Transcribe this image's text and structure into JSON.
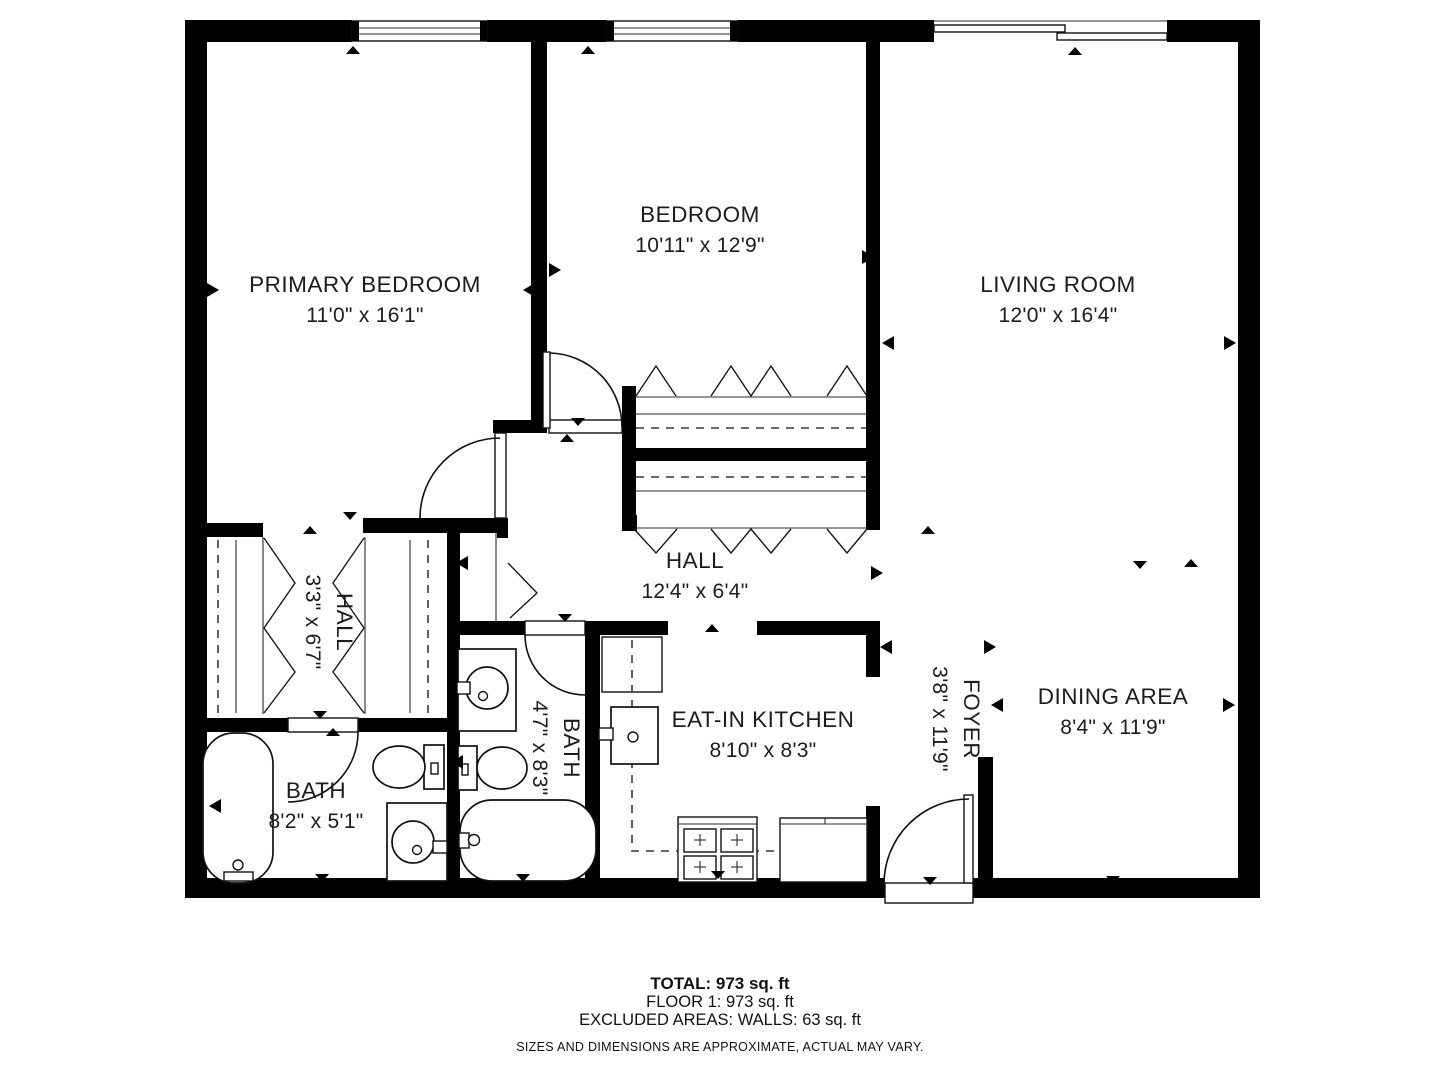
{
  "page": {
    "background": "#ffffff",
    "wall_color": "#000000",
    "text_color": "#1c1c1c"
  },
  "rooms": [
    {
      "id": "primary-bedroom",
      "name": "PRIMARY BEDROOM",
      "dims": "11'0\" x 16'1\"",
      "x": 365,
      "y": 292,
      "rotated": false
    },
    {
      "id": "bedroom",
      "name": "BEDROOM",
      "dims": "10'11\" x 12'9\"",
      "x": 700,
      "y": 222,
      "rotated": false
    },
    {
      "id": "living-room",
      "name": "LIVING ROOM",
      "dims": "12'0\" x 16'4\"",
      "x": 1058,
      "y": 292,
      "rotated": false
    },
    {
      "id": "hall",
      "name": "HALL",
      "dims": "12'4\" x 6'4\"",
      "x": 695,
      "y": 568,
      "rotated": false
    },
    {
      "id": "hall-small",
      "name": "HALL",
      "dims": "3'3\" x 6'7\"",
      "x": 322,
      "y": 622,
      "rotated": true
    },
    {
      "id": "bath-1",
      "name": "BATH",
      "dims": "8'2\" x 5'1\"",
      "x": 316,
      "y": 798,
      "rotated": false
    },
    {
      "id": "bath-2",
      "name": "BATH",
      "dims": "4'7\" x 8'3\"",
      "x": 549,
      "y": 748,
      "rotated": true
    },
    {
      "id": "eat-in-kitchen",
      "name": "EAT-IN KITCHEN",
      "dims": "8'10\" x 8'3\"",
      "x": 763,
      "y": 727,
      "rotated": false
    },
    {
      "id": "foyer",
      "name": "FOYER",
      "dims": "3'8\" x 11'9\"",
      "x": 949,
      "y": 719,
      "rotated": true
    },
    {
      "id": "dining-area",
      "name": "DINING AREA",
      "dims": "8'4\" x 11'9\"",
      "x": 1113,
      "y": 704,
      "rotated": false
    }
  ],
  "footer": {
    "total": "TOTAL: 973 sq. ft",
    "floor": "FLOOR 1: 973 sq. ft",
    "excluded": "EXCLUDED AREAS: WALLS: 63 sq. ft",
    "disclaimer": "SIZES AND DIMENSIONS ARE APPROXIMATE, ACTUAL MAY VARY."
  }
}
